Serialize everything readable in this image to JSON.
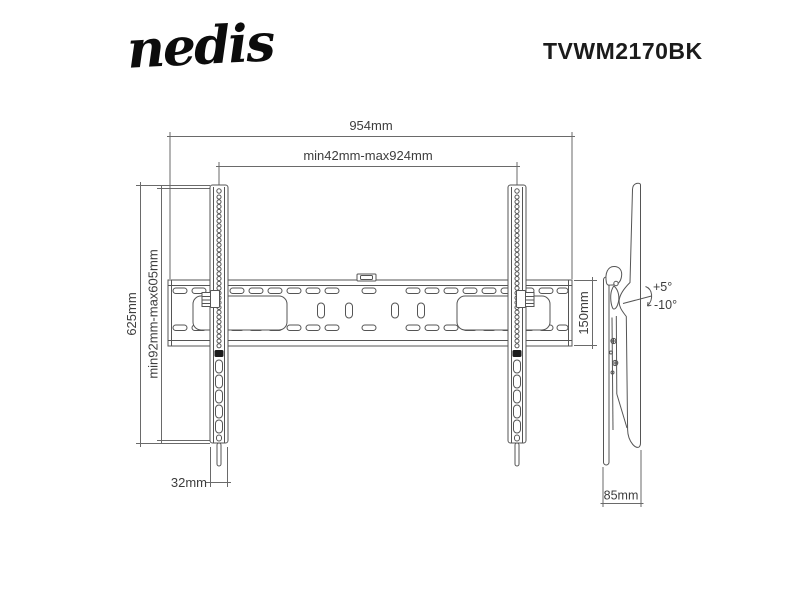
{
  "header": {
    "brand": "nedis",
    "model": "TVWM2170BK"
  },
  "front_view": {
    "width_total": "954mm",
    "width_range": "min42mm-max924mm",
    "height_total": "625mm",
    "height_range": "min92mm-max605mm",
    "rail_width": "32mm",
    "bar_height": "150mm"
  },
  "side_view": {
    "tilt_up": "+5°",
    "tilt_down": "-10°",
    "depth": "85mm"
  },
  "colors": {
    "drawing_line": "#555555",
    "dimension_line": "#6a6a6a",
    "label_text": "#3d3d3d",
    "brand_text": "#0c0c0c"
  }
}
